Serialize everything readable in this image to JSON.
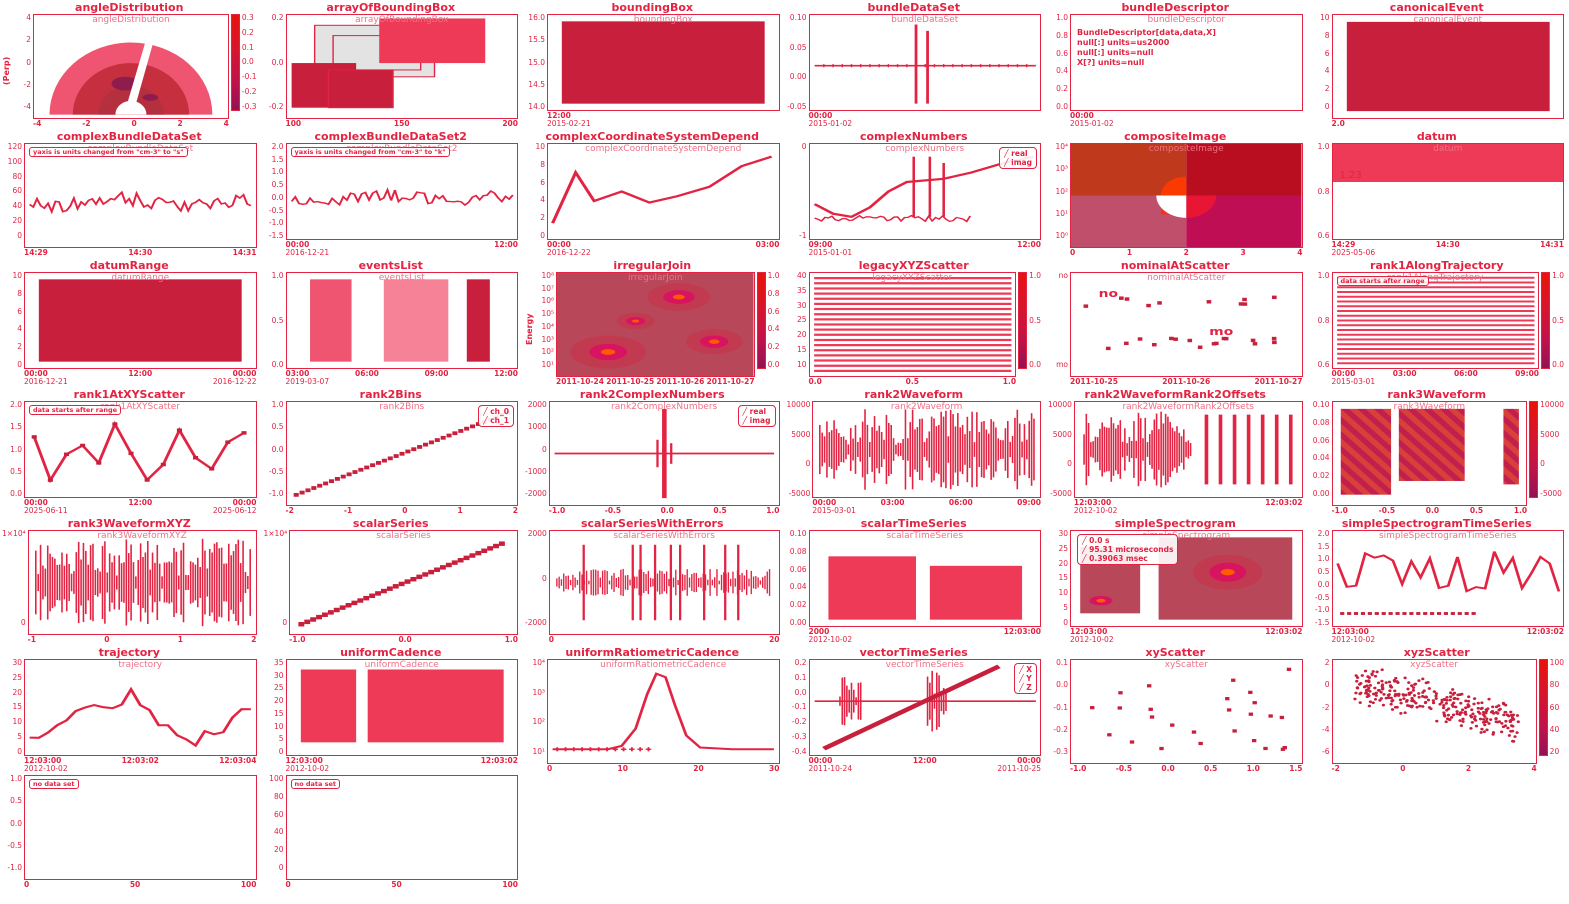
{
  "page": {
    "background": "#ffffff",
    "ink_color": "#e22342",
    "fill_color": "#ee3a57",
    "dark_fill": "#c81f3c"
  },
  "chart_data": [
    {
      "name": "angleDistribution",
      "title": "angleDistribution",
      "type": "angle",
      "ylabel": "(Perp)",
      "y_ticks": [
        "4",
        "2",
        "0",
        "-2",
        "-4"
      ],
      "x_ticks": [
        "-4",
        "-2",
        "0",
        "2",
        "4"
      ],
      "colorbar": [
        "0.3",
        "0.2",
        "0.1",
        "0.0",
        "-0.1",
        "-0.2",
        "-0.3"
      ]
    },
    {
      "name": "arrayOfBoundingBox",
      "title": "arrayOfBoundingBox",
      "type": "boxes",
      "y_ticks": [
        "0.2",
        "0.0",
        "-0.2"
      ],
      "x_ticks": [
        "100",
        "150",
        "200"
      ]
    },
    {
      "name": "boundingBox",
      "title": "boundingBox",
      "type": "block",
      "y_ticks": [
        "16.0",
        "15.5",
        "15.0",
        "14.5",
        "14.0"
      ],
      "x_ticks": [
        "12:00"
      ],
      "dates": [
        "2015-02-21"
      ]
    },
    {
      "name": "bundleDataSet",
      "title": "bundleDataSet",
      "type": "spike-line",
      "y_ticks": [
        "0.10",
        "0.05",
        "0.00",
        "-0.05"
      ],
      "x_ticks": [
        "00:00"
      ],
      "dates": [
        "2015-01-02"
      ]
    },
    {
      "name": "bundleDescriptor",
      "title": "bundleDescriptor",
      "type": "text",
      "text_lines": [
        "BundleDescriptor[data,data,X]",
        "null[:] units=us2000",
        "null[:] units=null",
        "X[?] units=null"
      ],
      "y_ticks": [
        "1.0",
        "0.8",
        "0.6",
        "0.4",
        "0.2",
        "0.0"
      ],
      "x_ticks": [
        "00:00"
      ],
      "dates": [
        "2015-01-02"
      ]
    },
    {
      "name": "canonicalEvent",
      "title": "canonicalEvent",
      "type": "block",
      "y_ticks": [
        "10",
        "8",
        "6",
        "4",
        "2",
        "0"
      ],
      "x_ticks": [
        "2.0"
      ]
    },
    {
      "name": "complexBundleDataSet",
      "title": "complexBundleDataSet",
      "type": "noisy",
      "annotation": "yaxis is units changed from \"cm-3\" to \"s\"",
      "y_ticks": [
        "120",
        "100",
        "80",
        "60",
        "40",
        "20",
        "0"
      ],
      "x_ticks": [
        "14:29",
        "14:30",
        "14:31"
      ]
    },
    {
      "name": "complexBundleDataSet2",
      "title": "complexBundleDataSet2",
      "type": "noisy",
      "annotation": "yaxis is units changed from \"cm-3\" to \"k\"",
      "y_ticks": [
        "2.0",
        "1.5",
        "1.0",
        "0.5",
        "0.0",
        "-0.5",
        "-1.0",
        "-1.5"
      ],
      "x_ticks": [
        "00:00",
        "12:00"
      ],
      "dates": [
        "2016-12-21"
      ]
    },
    {
      "name": "complexCoordinateSystemDepend",
      "title": "complexCoordinateSystemDepend",
      "type": "line",
      "inner_label": "real, imag",
      "y_ticks": [
        "10",
        "8",
        "6",
        "4",
        "2",
        "0"
      ],
      "x_ticks": [
        "00:00",
        "03:00"
      ],
      "dates": [
        "2016-12-22"
      ]
    },
    {
      "name": "complexNumbers",
      "title": "complexNumbers",
      "type": "spikes-line",
      "legend": [
        "real",
        "imag"
      ],
      "y_ticks": [
        "0",
        "-1"
      ],
      "x_ticks": [
        "09:00",
        "12:00"
      ],
      "dates": [
        "2015-01-01"
      ]
    },
    {
      "name": "compositeImage",
      "title": "compositeImage",
      "type": "quadrants",
      "y_ticks": [
        "10⁴",
        "10³",
        "10²",
        "10¹",
        "10⁰"
      ],
      "x_ticks": [
        "0",
        "1",
        "2",
        "3",
        "4"
      ]
    },
    {
      "name": "datum",
      "title": "datum",
      "type": "value",
      "value": "1.23",
      "y_ticks": [
        "1.0",
        "0.8",
        "0.6"
      ],
      "x_ticks": [
        "14:29",
        "14:30",
        "14:31"
      ],
      "dates": [
        "2025-05-06"
      ]
    },
    {
      "name": "datumRange",
      "title": "datumRange",
      "type": "block",
      "y_ticks": [
        "10",
        "8",
        "6",
        "4",
        "2",
        "0"
      ],
      "x_ticks": [
        "00:00",
        "12:00",
        "00:00"
      ],
      "dates": [
        "2016-12-21",
        "2016-12-22"
      ]
    },
    {
      "name": "eventsList",
      "title": "eventsList",
      "type": "event-blocks",
      "y_ticks": [
        "1.0",
        "0.5",
        "0.0"
      ],
      "x_ticks": [
        "03:00",
        "06:00",
        "09:00",
        "12:00"
      ],
      "dates": [
        "2019-03-07"
      ]
    },
    {
      "name": "irregularJoin",
      "title": "irregularJoin",
      "type": "spectro",
      "ylabel": "Energy",
      "y_ticks": [
        "10⁸",
        "10⁷",
        "10⁶",
        "10⁵",
        "10⁴",
        "10³",
        "10²",
        "10¹"
      ],
      "x_ticks": [
        "2011-10-24",
        "2011-10-25",
        "2011-10-26",
        "2011-10-27"
      ],
      "colorbar": [
        "1.0",
        "0.8",
        "0.6",
        "0.4",
        "0.2",
        "0.0"
      ]
    },
    {
      "name": "legacyXYZScatter",
      "title": "legacyXYZScatter",
      "type": "stripes",
      "y_ticks": [
        "40",
        "35",
        "30",
        "25",
        "20",
        "15",
        "10"
      ],
      "x_ticks": [
        "0.0",
        "0.5",
        "1.0"
      ],
      "colorbar": [
        "1.0",
        "0.5",
        "0.0"
      ]
    },
    {
      "name": "nominalAtScatter",
      "title": "nominalAtScatter",
      "type": "nominal",
      "y_ticks": [
        "no",
        "mo"
      ],
      "x_ticks": [
        "2011-10-25",
        "2011-10-26",
        "2011-10-27"
      ]
    },
    {
      "name": "rank1AlongTrajectory",
      "title": "rank1AlongTrajectory",
      "type": "stripes",
      "annotation": "data starts after range",
      "y_ticks": [
        "1.0",
        "0.8",
        "0.6"
      ],
      "x_ticks": [
        "00:00",
        "03:00",
        "06:00",
        "09:00"
      ],
      "dates": [
        "2015-03-01"
      ],
      "colorbar": [
        "1.0",
        "0.5",
        "0.0"
      ]
    },
    {
      "name": "rank1AtXYScatter",
      "title": "rank1AtXYScatter",
      "type": "zigzag",
      "annotation": "data starts after range",
      "y_ticks": [
        "2.0",
        "1.5",
        "1.0",
        "0.5",
        "0.0"
      ],
      "x_ticks": [
        "00:00",
        "12:00",
        "00:00"
      ],
      "dates": [
        "2025-06-11",
        "2025-06-12"
      ]
    },
    {
      "name": "rank2Bins",
      "title": "rank2Bins",
      "type": "diag-dots",
      "legend": [
        "ch_0",
        "ch_1"
      ],
      "y_ticks": [
        "1.0",
        "0.5",
        "0.0",
        "-0.5",
        "-1.0"
      ],
      "x_ticks": [
        "-2",
        "-1",
        "0",
        "1",
        "2"
      ]
    },
    {
      "name": "rank2ComplexNumbers",
      "title": "rank2ComplexNumbers",
      "type": "center-spike",
      "legend": [
        "real",
        "imag"
      ],
      "y_ticks": [
        "2000",
        "1000",
        "0",
        "-1000",
        "-2000"
      ],
      "x_ticks": [
        "-1.0",
        "-0.5",
        "0.0",
        "0.5",
        "1.0"
      ]
    },
    {
      "name": "rank2Waveform",
      "title": "rank2Waveform",
      "type": "waveform",
      "y_ticks": [
        "10000",
        "5000",
        "0",
        "-5000"
      ],
      "x_ticks": [
        "00:00",
        "03:00",
        "06:00",
        "09:00"
      ],
      "dates": [
        "2015-03-01"
      ]
    },
    {
      "name": "rank2WaveformRank2Offsets",
      "title": "rank2WaveformRank2Offsets",
      "type": "waveform-burst",
      "y_ticks": [
        "10000",
        "5000",
        "0",
        "-5000"
      ],
      "x_ticks": [
        "12:03:00",
        "12:03:02"
      ],
      "dates": [
        "2012-10-02"
      ]
    },
    {
      "name": "rank3Waveform",
      "title": "rank3Waveform",
      "type": "hatch-blocks",
      "y_ticks": [
        "0.10",
        "0.08",
        "0.06",
        "0.04",
        "0.02",
        "0.00"
      ],
      "x_ticks": [
        "-1.0",
        "-0.5",
        "0.0",
        "0.5",
        "1.0"
      ],
      "colorbar": [
        "10000",
        "5000",
        "0",
        "-5000"
      ]
    },
    {
      "name": "rank3WaveformXYZ",
      "title": "rank3WaveformXYZ",
      "type": "waveform",
      "y_ticks": [
        "1×10⁴",
        "0"
      ],
      "x_ticks": [
        "-1",
        "0",
        "1",
        "2"
      ]
    },
    {
      "name": "scalarSeries",
      "title": "scalarSeries",
      "type": "diag-markers",
      "y_ticks": [
        "1×10⁴",
        "0"
      ],
      "x_ticks": [
        "-1.0",
        "0.0",
        "1.0"
      ]
    },
    {
      "name": "scalarSeriesWithErrors",
      "title": "scalarSeriesWithErrors",
      "type": "noisy-band",
      "y_ticks": [
        "2000",
        "0",
        "-2000"
      ],
      "x_ticks": [
        "0",
        "20"
      ]
    },
    {
      "name": "scalarTimeSeries",
      "title": "scalarTimeSeries",
      "type": "blocks2",
      "y_ticks": [
        "0.10",
        "0.08",
        "0.06",
        "0.04",
        "0.02",
        "0.00"
      ],
      "x_ticks": [
        "2000",
        "12:03:00"
      ],
      "dates": [
        "2012-10-02"
      ]
    },
    {
      "name": "simpleSpectrogram",
      "title": "simpleSpectrogram",
      "type": "spectro2",
      "legend": [
        "0.0 s",
        "95.31 microseconds",
        "0.39063 msec"
      ],
      "legend_pos": "left",
      "y_ticks": [
        "30",
        "25",
        "20",
        "15",
        "10",
        "5",
        "0"
      ],
      "x_ticks": [
        "12:03:00",
        "12:03:02"
      ],
      "dates": [
        "2012-10-02"
      ]
    },
    {
      "name": "simpleSpectrogramTimeSeries",
      "title": "simpleSpectrogramTimeSeries",
      "type": "line-dots",
      "y_ticks": [
        "2.0",
        "1.5",
        "1.0",
        "0.5",
        "0.0",
        "-0.5",
        "-1.0",
        "-1.5"
      ],
      "x_ticks": [
        "12:03:00",
        "12:03:02"
      ],
      "dates": [
        "2012-10-02"
      ]
    },
    {
      "name": "trajectory",
      "title": "trajectory",
      "type": "wiggle",
      "y_ticks": [
        "30",
        "25",
        "20",
        "15",
        "10",
        "5",
        "0"
      ],
      "x_ticks": [
        "12:03:00",
        "12:03:02",
        "12:03:04"
      ],
      "dates": [
        "2012-10-02"
      ]
    },
    {
      "name": "uniformCadence",
      "title": "uniformCadence",
      "type": "block-split",
      "y_ticks": [
        "35",
        "30",
        "25",
        "20",
        "15",
        "10",
        "5",
        "0"
      ],
      "x_ticks": [
        "12:03:00",
        "12:03:02"
      ],
      "dates": [
        "2012-10-02"
      ]
    },
    {
      "name": "uniformRatiometricCadence",
      "title": "uniformRatiometricCadence",
      "type": "peak",
      "y_ticks": [
        "10⁴",
        "10³",
        "10²",
        "10¹"
      ],
      "x_ticks": [
        "0",
        "10",
        "20",
        "30"
      ]
    },
    {
      "name": "vectorTimeSeries",
      "title": "vectorTimeSeries",
      "type": "vector",
      "legend": [
        "X",
        "Y",
        "Z"
      ],
      "y_ticks": [
        "0.2",
        "0.1",
        "0.0",
        "-0.1",
        "-0.2",
        "-0.3",
        "-0.4"
      ],
      "x_ticks": [
        "00:00",
        "12:00",
        "00:00"
      ],
      "dates": [
        "2011-10-24",
        "2011-10-25"
      ]
    },
    {
      "name": "xyScatter",
      "title": "xyScatter",
      "type": "scatter-sparse",
      "y_ticks": [
        "0.1",
        "0.0",
        "-0.1",
        "-0.2",
        "-0.3"
      ],
      "x_ticks": [
        "-1.0",
        "-0.5",
        "0.0",
        "0.5",
        "1.0",
        "1.5"
      ]
    },
    {
      "name": "xyzScatter",
      "title": "xyzScatter",
      "type": "scatter-dense",
      "y_ticks": [
        "2",
        "0",
        "-2",
        "-4",
        "-6"
      ],
      "x_ticks": [
        "-2",
        "0",
        "2",
        "4"
      ],
      "colorbar": [
        "100",
        "80",
        "60",
        "40",
        "20"
      ]
    },
    {
      "name": "emptyPanel1",
      "title": "",
      "type": "empty",
      "annotation": "no data set",
      "y_ticks": [
        "1.0",
        "0.5",
        "0.0",
        "-0.5",
        "-1.0"
      ],
      "x_ticks": [
        "0",
        "50",
        "100"
      ]
    },
    {
      "name": "emptyPanel2",
      "title": "",
      "type": "empty",
      "annotation": "no data set",
      "y_ticks": [
        "100",
        "80",
        "60",
        "40",
        "20",
        "0"
      ],
      "x_ticks": [
        "0",
        "50",
        "100"
      ]
    }
  ]
}
